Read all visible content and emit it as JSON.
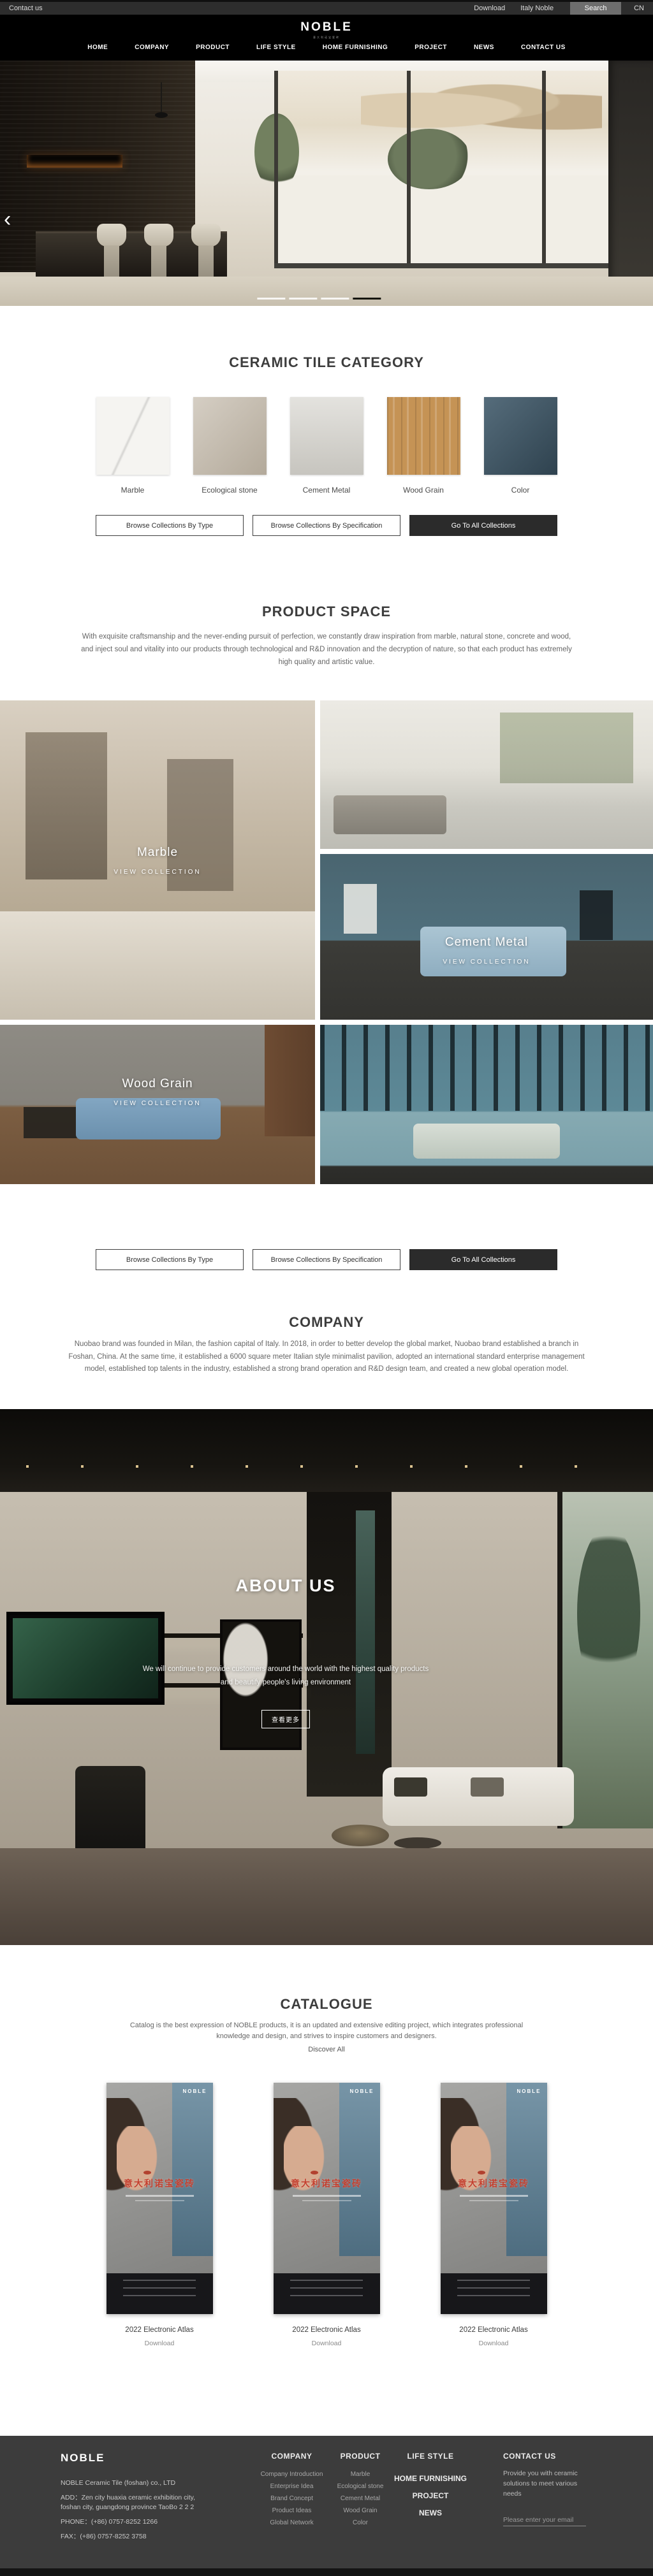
{
  "topbar": {
    "contact_us": "Contact us",
    "download": "Download",
    "italy_noble": "Italy Noble",
    "search": "Search",
    "lang": "CN"
  },
  "header": {
    "logo": "NOBLE",
    "tagline": "意大利诺宝瓷砖",
    "nav": [
      "HOME",
      "COMPANY",
      "PRODUCT",
      "LIFE STYLE",
      "HOME FURNISHING",
      "PROJECT",
      "NEWS",
      "CONTACT US"
    ]
  },
  "hero": {
    "prev": "‹"
  },
  "category": {
    "title": "CERAMIC TILE CATEGORY",
    "tiles": [
      {
        "label": "Marble",
        "color": "#f5f4f1"
      },
      {
        "label": "Ecological stone",
        "color": "#c7beb0"
      },
      {
        "label": "Cement Metal",
        "color": "#d8d6d0"
      },
      {
        "label": "Wood Grain",
        "color": "#c59355"
      },
      {
        "label": "Color",
        "color": "#3e5869"
      }
    ],
    "buttons": [
      {
        "label": "Browse Collections By Type",
        "style": "outline"
      },
      {
        "label": "Browse Collections By Specification",
        "style": "outline"
      },
      {
        "label": "Go To All Collections",
        "style": "dark"
      }
    ]
  },
  "product_space": {
    "title": "PRODUCT SPACE",
    "paragraph": "With exquisite craftsmanship and the never-ending pursuit of perfection, we constantly draw inspiration from marble, natural stone, concrete and wood, and inject soul and vitality into our products through technological and R&D innovation and the decryption of nature, so that each product has extremely high quality and artistic value.",
    "cards": [
      {
        "name": "Marble",
        "cta": "VIEW COLLECTION"
      },
      {
        "name": "",
        "cta": ""
      },
      {
        "name": "Cement Metal",
        "cta": "VIEW COLLECTION"
      },
      {
        "name": "Wood Grain",
        "cta": "VIEW COLLECTION"
      },
      {
        "name": "",
        "cta": ""
      }
    ]
  },
  "company": {
    "title": "COMPANY",
    "paragraph": "Nuobao brand was founded in Milan, the fashion capital of Italy. In 2018, in order to better develop the global market, Nuobao brand established a branch in Foshan, China. At the same time, it established a 6000 square meter Italian style minimalist pavilion, adopted an international standard enterprise management model, established top talents in the industry, established a strong brand operation and R&D design team, and created a new global operation model."
  },
  "about": {
    "title": "ABOUT US",
    "line1": "We will continue to provide customers around the world with the highest quality products",
    "line2": "and beautify people's living environment",
    "more": "查看更多"
  },
  "catalogue": {
    "title": "CATALOGUE",
    "paragraph": "Catalog is the best expression of NOBLE products, it is an updated and extensive editing project, which integrates professional knowledge and design, and strives to inspire customers and designers.",
    "discover": "Discover All",
    "poster": {
      "brand": "NOBLE",
      "title_cn": "意大利诺宝瓷砖"
    },
    "items": [
      {
        "title": "2022 Electronic Atlas",
        "download": "Download"
      },
      {
        "title": "2022 Electronic Atlas",
        "download": "Download"
      },
      {
        "title": "2022 Electronic Atlas",
        "download": "Download"
      }
    ]
  },
  "footer": {
    "brand": "NOBLE",
    "company_name": "NOBLE Ceramic Tile (foshan) co., LTD",
    "address": "ADD：Zen city huaxia ceramic exhibition city, foshan city, guangdong province TaoBo 2 2 2",
    "phone": "PHONE：(+86) 0757-8252 1266",
    "fax": "FAX：(+86) 0757-8252 3758",
    "company_col": {
      "title": "COMPANY",
      "links": [
        "Company Introduction",
        "Enterprise Idea",
        "Brand Concept",
        "Product Ideas",
        "Global Network"
      ]
    },
    "product_col": {
      "title": "PRODUCT",
      "links": [
        "Marble",
        "Ecological stone",
        "Cement Metal",
        "Wood Grain",
        "Color"
      ]
    },
    "nav_col": [
      "LIFE STYLE",
      "HOME FURNISHING",
      "PROJECT",
      "NEWS"
    ],
    "contact_col": {
      "title": "CONTACT US",
      "blurb": "Provide you with ceramic solutions to meet various needs",
      "placeholder": "Please enter your email"
    }
  },
  "colors": {
    "dark_button": "#2b2b2b",
    "poster_red": "#c43f2e",
    "footer_bg": "#3c3c3c",
    "topbar_bg": "#2d2d2d",
    "header_bg": "#000000"
  }
}
